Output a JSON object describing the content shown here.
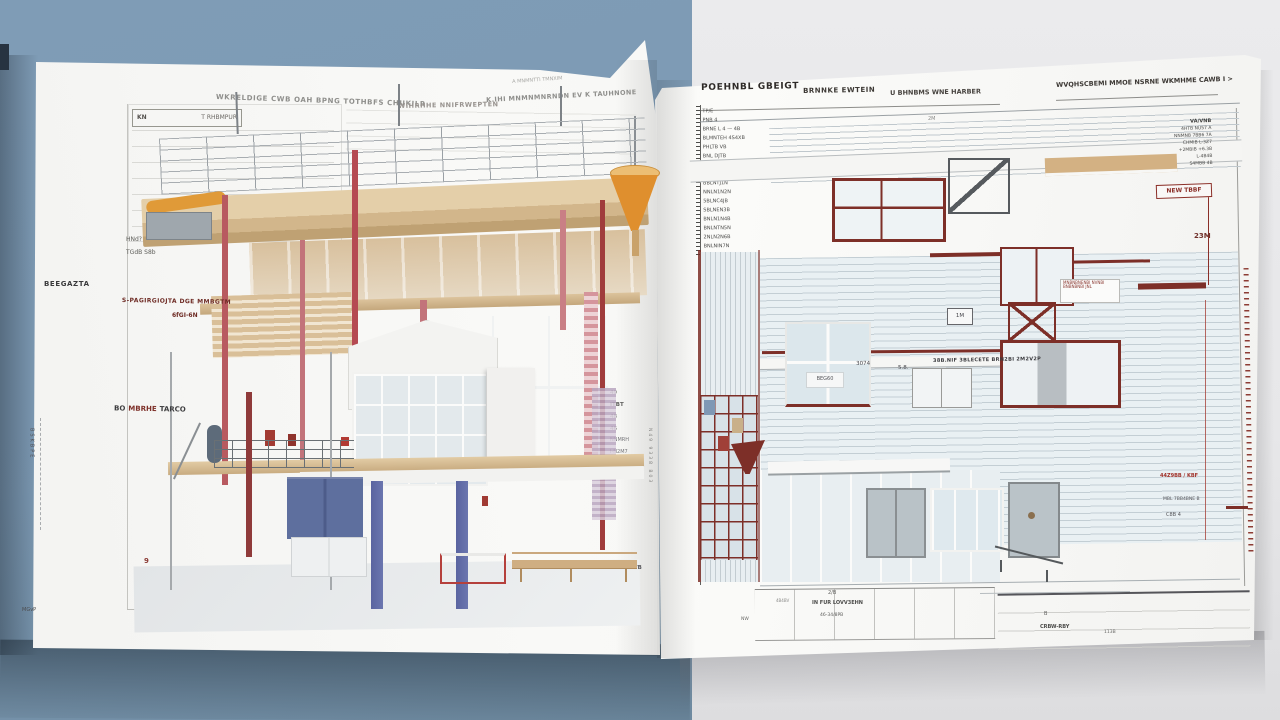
{
  "scene": {
    "description": "Open folded architectural drawing spread on two-tone backdrop",
    "colors": {
      "bg_left": "#7d9ab4",
      "bg_right": "#e9e9ea",
      "page": "#f7f7f5",
      "maroon_line": "#7d2f28",
      "wood": "#d5ba92",
      "orange_funnel": "#df8f2e",
      "pale_siding": "#e9f0f3",
      "panel_blue": "#5e6f9e",
      "glass_blue": "#7b97ac",
      "column_red": "#a03c3c"
    }
  },
  "left_page": {
    "top_note": "A MNMNTTI TMNXIM",
    "header_seg1": "WKRELDIGE CWB OAH BPNG TOTHBFS CHUKILR",
    "header_seg2": "WIHRHHE NNIFRWEPTEN",
    "header_seg3": "K.IHI MNMNMNRNDN EV K TAUHNONE",
    "legend": {
      "col1": "KN",
      "col2": "T RHBMPUR"
    },
    "labels": {
      "side": "BEEGAZTA",
      "red_line1": "S-PAGIRGIOJTA DGE MMBGTM",
      "red_line2": "6fGI-6N",
      "small1": "HNd?",
      "small2": "TGdB S8b",
      "mid_prefix": "BO",
      "mid_red": "MBRHE",
      "mid_suffix": "TARCO",
      "corner_number": "9",
      "margin_bottom": "MGvP",
      "margin_vertical": "BSKBPE"
    },
    "fold_annotations": [
      "49",
      "ITBT",
      "48",
      "46",
      "NNMRH",
      "I-N2M7",
      "IL302U%",
      "CXX"
    ],
    "fold_note": "301 CAVB",
    "fold_vertical": "N49 9338 B03"
  },
  "right_page": {
    "header": {
      "bold": "POEHNBL GBEIGT",
      "sub1": "BRNNKE EWTEIN",
      "sub2": "U BHNBMS WNE HARBER",
      "right": "WVQHSCBEMI MMOE NSRNE WKMHME CAWB I >"
    },
    "schedule_rows": [
      "TP/E",
      "PNB 4",
      "BRNE L 4 — 4B",
      "BLMNTEH 4S4XB",
      "PHLTB VB",
      "BNL DJTB",
      "PNL DJTN",
      "BNLI ZNTN",
      "BBLNTJ1N",
      "NNLN1N2N",
      "5BLNC4JB",
      "SBLNEN3B",
      "BNLN1N4B",
      "BNLNTN5N",
      "2NLN2N6B",
      "BNLNIN7N"
    ],
    "levels": [
      "VA/VNB",
      "4HTB NU57 A",
      "NNMNB 7BB6 7A",
      "CHMIB L-3Z7",
      "+2MBIB +6.3B",
      "L-4B4B",
      "S4MBB 4B"
    ],
    "labels": {
      "dim_2m": "2M",
      "new_roof": "NEW TBBF",
      "dim_23m": "23M",
      "num_3074": "3074",
      "num_58": "5.8.",
      "band_text": "38B.NIF 3BLECETE BRN2BI 2M2V2P",
      "beg60": "BEG60",
      "boxed_1m": "1M",
      "red_kbf": "44Z9BB / KBF",
      "note1": "MBL 7BB4BNE B",
      "note2": "C8B 4"
    },
    "callout": {
      "line1": "MNBNBNENBI NVNBI",
      "line2": "BNBNBNBI JNL"
    },
    "titleblock": {
      "t1": "2/B",
      "t2": "IN FUR LOVV3EHN",
      "t3": "46-34/8PB",
      "t4": "4B4BV",
      "t5": "NW",
      "r1": "B",
      "r2": "CRBW-RBY",
      "r3": "113B"
    }
  }
}
